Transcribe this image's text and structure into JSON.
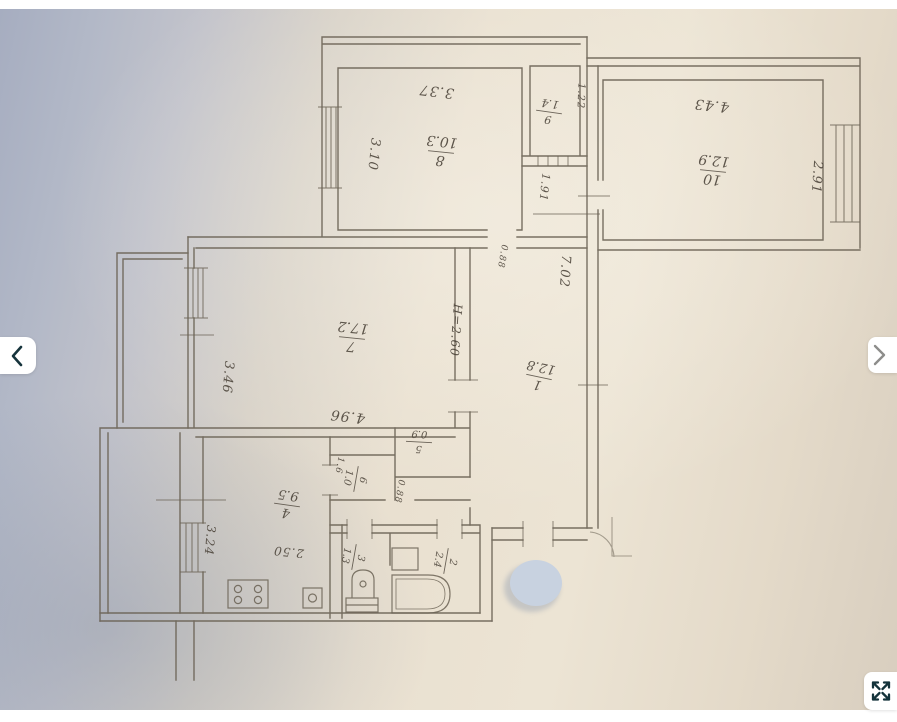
{
  "viewer": {
    "type": "photo-gallery-viewer",
    "photo_subject": "apartment floor plan (hand-drawn BTI scheme)",
    "controls": {
      "prev_icon": "chevron-left",
      "next_icon": "chevron-right",
      "fullscreen_icon": "expand-arrows"
    }
  },
  "colors": {
    "paper": "#ece4d4",
    "backdrop_blue": "#a6adc0",
    "line": "#6a6254",
    "ink": "#4a4238",
    "watermark": "#c8d2e0",
    "prev_chevron": "#16343c",
    "next_chevron": "#8d8d8b",
    "fullscreen_icon_color": "#14333b",
    "top_bar": "#ffffff",
    "bottom_bar": "#ffffff"
  },
  "plan": {
    "room_labels": [
      {
        "num": "8",
        "den": "10.3",
        "x": 441,
        "y": 152,
        "r": 186,
        "s": 14
      },
      {
        "num": "9",
        "den": "1.4",
        "x": 549,
        "y": 112,
        "r": 188,
        "s": 11
      },
      {
        "num": "10",
        "den": "12.9",
        "x": 713,
        "y": 171,
        "r": 186,
        "s": 14
      },
      {
        "num": "7",
        "den": "17.2",
        "x": 352,
        "y": 338,
        "r": 186,
        "s": 14
      },
      {
        "num": "1",
        "den": "12.8",
        "x": 539,
        "y": 377,
        "r": 192,
        "s": 13
      },
      {
        "num": "4",
        "den": "9.5",
        "x": 287,
        "y": 505,
        "r": 188,
        "s": 13
      },
      {
        "num": "5",
        "den": "0.9",
        "x": 419,
        "y": 442,
        "r": 183,
        "s": 10
      },
      {
        "num": "6",
        "den": "1.0",
        "x": 356,
        "y": 479,
        "r": 100,
        "s": 10
      },
      {
        "num": "3",
        "den": "1.3",
        "x": 354,
        "y": 557,
        "r": 100,
        "s": 10
      },
      {
        "num": "2",
        "den": "2.4",
        "x": 446,
        "y": 561,
        "r": 100,
        "s": 10
      }
    ],
    "dimension_labels": [
      {
        "t": "3.37",
        "x": 437,
        "y": 87,
        "r": 187,
        "s": 14
      },
      {
        "t": "3.10",
        "x": 370,
        "y": 154,
        "r": 96,
        "s": 13
      },
      {
        "t": "1.22",
        "x": 578,
        "y": 96,
        "r": 92,
        "s": 10
      },
      {
        "t": "1.91",
        "x": 541,
        "y": 187,
        "r": 96,
        "s": 11
      },
      {
        "t": "4.43",
        "x": 712,
        "y": 101,
        "r": 186,
        "s": 14
      },
      {
        "t": "2.91",
        "x": 813,
        "y": 177,
        "r": 94,
        "s": 13
      },
      {
        "t": "7.02",
        "x": 561,
        "y": 271,
        "r": 94,
        "s": 13
      },
      {
        "t": "0.88",
        "x": 500,
        "y": 256,
        "r": 100,
        "s": 9
      },
      {
        "t": "H=2.60",
        "x": 452,
        "y": 330,
        "r": 94,
        "s": 12
      },
      {
        "t": "3.46",
        "x": 224,
        "y": 377,
        "r": 95,
        "s": 13
      },
      {
        "t": "4.96",
        "x": 348,
        "y": 412,
        "r": 187,
        "s": 14
      },
      {
        "t": "1.6",
        "x": 337,
        "y": 465,
        "r": 100,
        "s": 9
      },
      {
        "t": "0.88",
        "x": 397,
        "y": 491,
        "r": 100,
        "s": 9
      },
      {
        "t": "2.50",
        "x": 289,
        "y": 548,
        "r": 186,
        "s": 12
      },
      {
        "t": "3.24",
        "x": 206,
        "y": 540,
        "r": 95,
        "s": 12
      }
    ],
    "fixtures": [
      "bathtub",
      "toilet",
      "kitchen-stove",
      "kitchen-sink",
      "washbasin"
    ],
    "features": [
      "windows-with-hatch",
      "door-openings",
      "entrance-door-swing",
      "watermark-dot",
      "balcony-left",
      "stair-stub-bottom"
    ]
  }
}
